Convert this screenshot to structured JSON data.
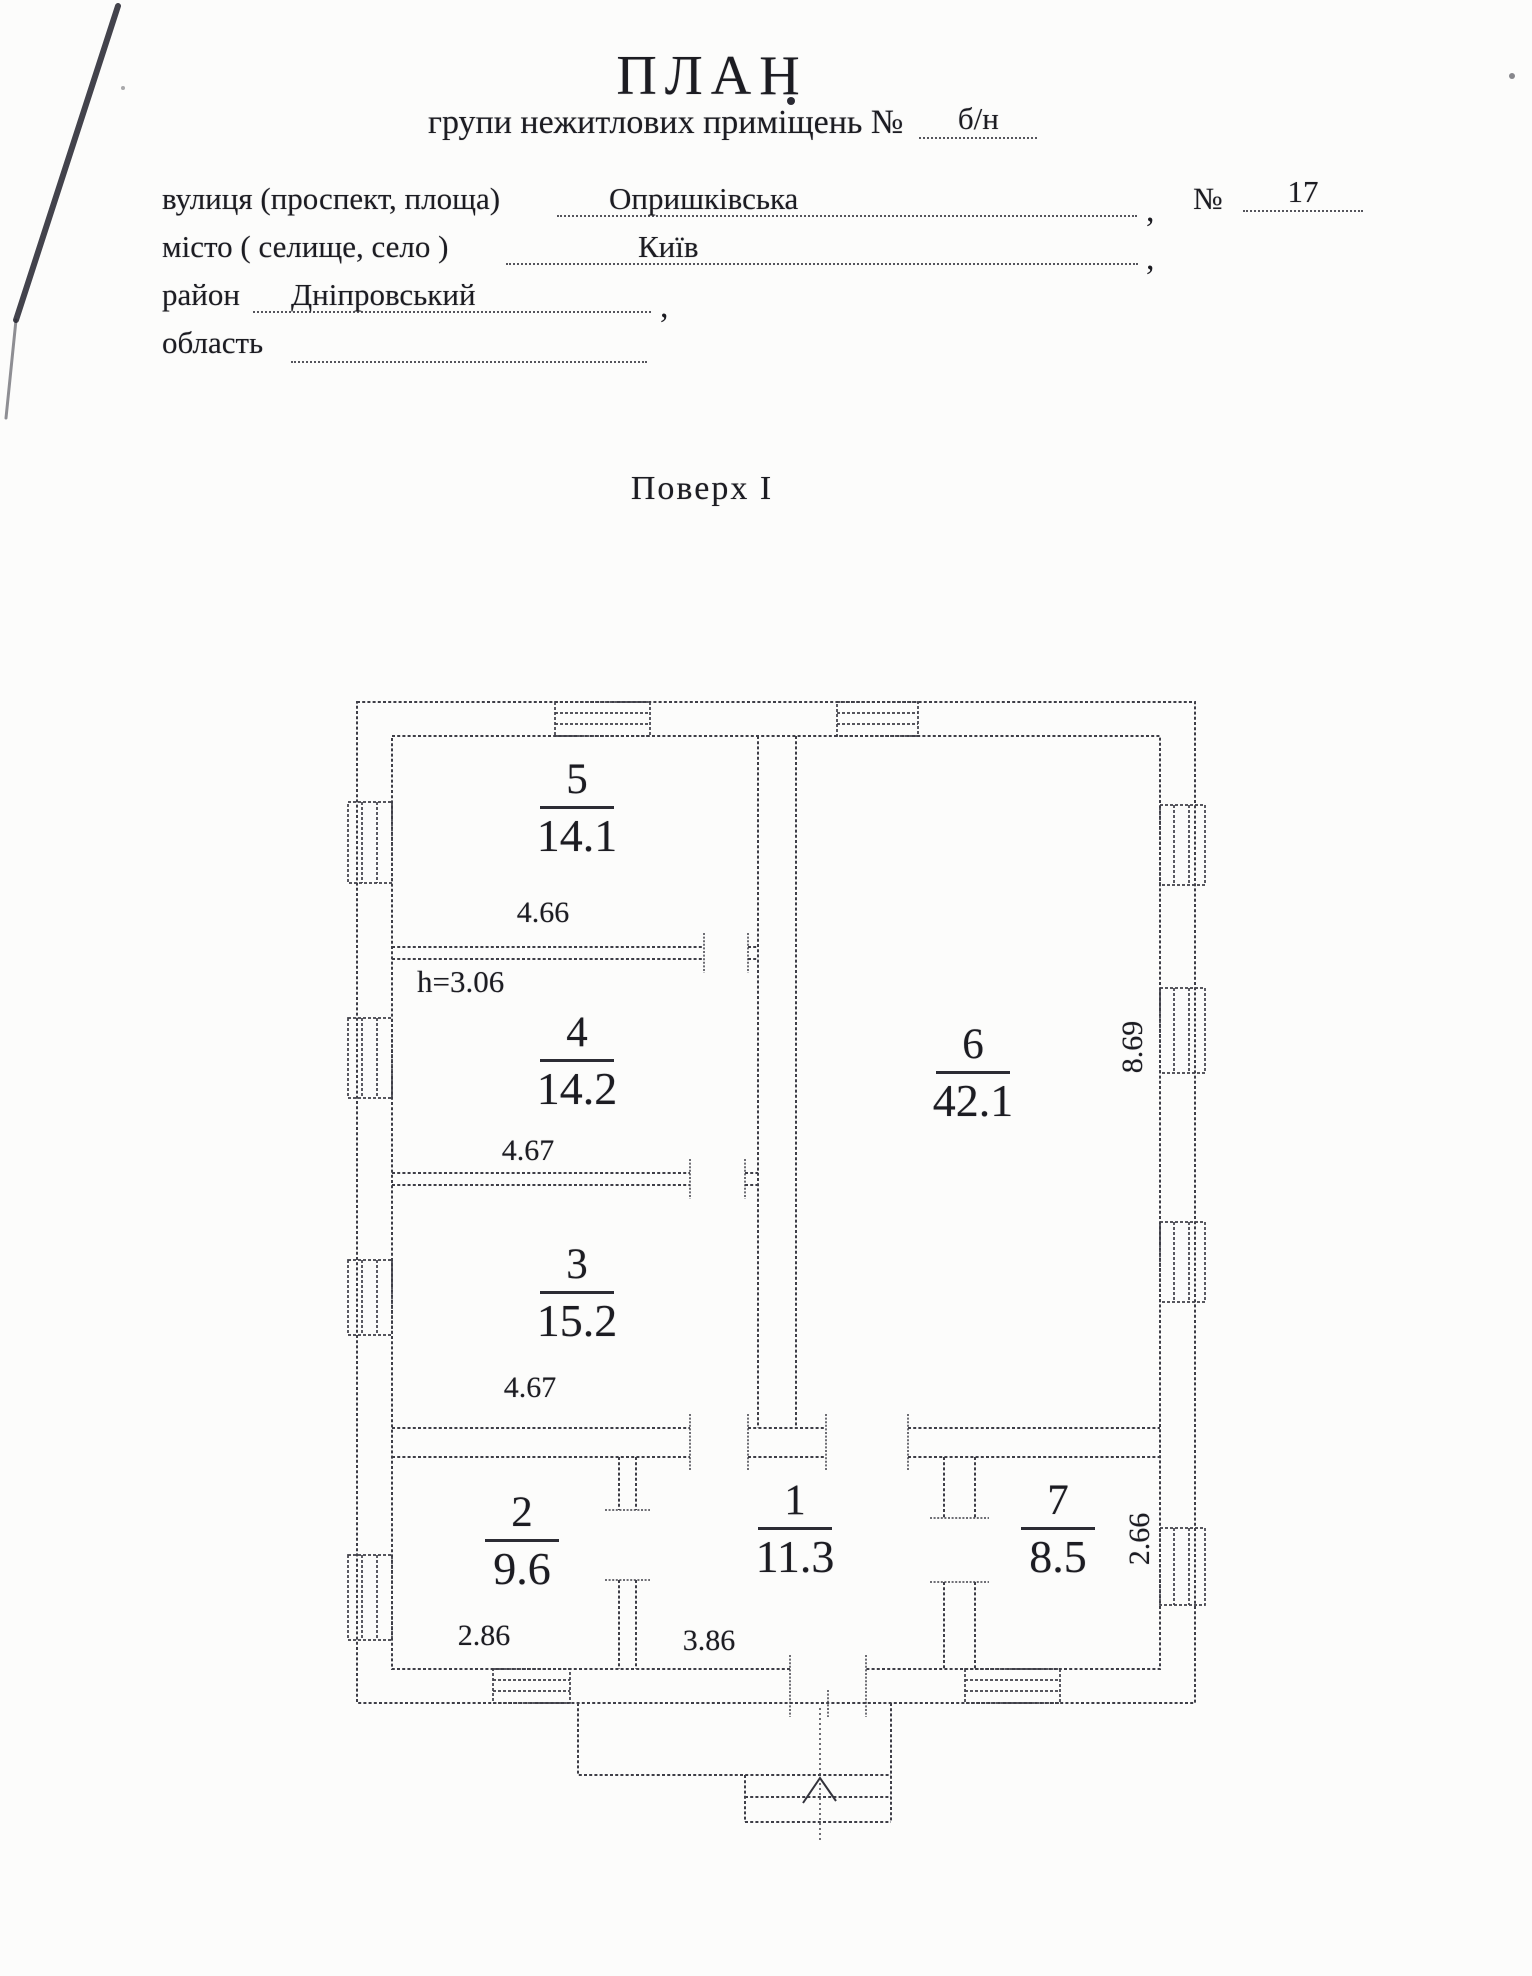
{
  "header": {
    "title": "ПЛАН",
    "subtitle": {
      "label": "групи нежитлових приміщень №",
      "value": "б/н"
    },
    "rows": [
      {
        "label": "вулиця (проспект, площа)",
        "value": "Опришківська",
        "comma": ",",
        "num_sign": "№",
        "num_value": "17"
      },
      {
        "label": "місто ( селище, село )",
        "value": "Київ",
        "comma": ","
      },
      {
        "label": "район",
        "value": "Дніпровський",
        "comma": ","
      },
      {
        "label": "область",
        "value": ""
      }
    ]
  },
  "floor": {
    "title": "Поверх I"
  },
  "plan": {
    "height_note": "h=3.06",
    "rooms": [
      {
        "number": "5",
        "area": "14.1",
        "dim": "4.66"
      },
      {
        "number": "4",
        "area": "14.2",
        "dim": "4.67"
      },
      {
        "number": "3",
        "area": "15.2",
        "dim": "4.67"
      },
      {
        "number": "6",
        "area": "42.1",
        "dim": "8.69"
      },
      {
        "number": "2",
        "area": "9.6",
        "dim": "2.86"
      },
      {
        "number": "1",
        "area": "11.3",
        "dim": "3.86"
      },
      {
        "number": "7",
        "area": "8.5",
        "dim": "2.66"
      }
    ]
  }
}
